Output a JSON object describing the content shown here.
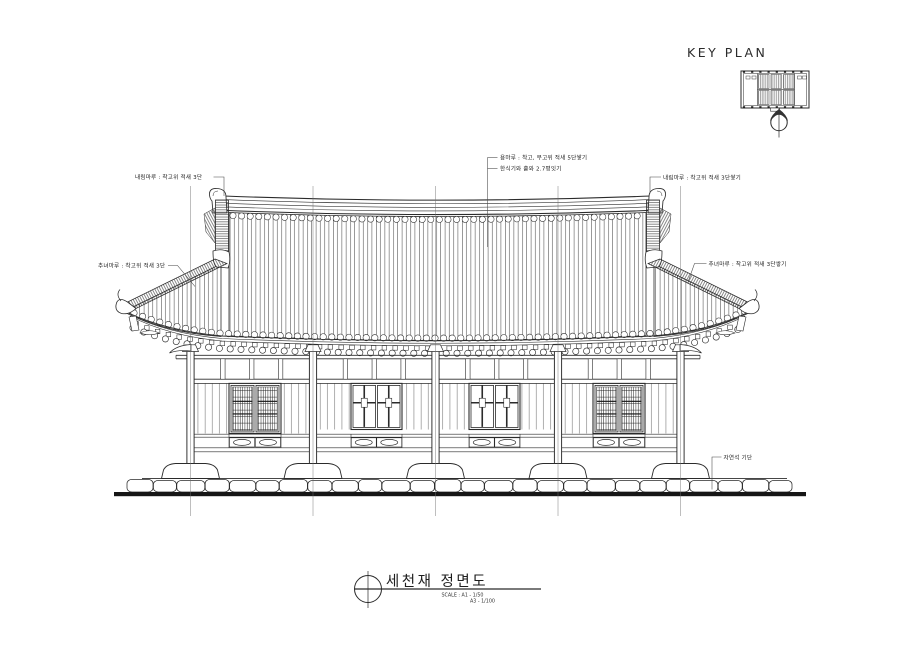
{
  "page": {
    "background": "#ffffff",
    "line_color": "#2b2b2b"
  },
  "key_plan": {
    "label": "KEY PLAN"
  },
  "annotations": {
    "ridge_line1": "용마루 : 착고, 부고위 적새 5단쌓기",
    "ridge_line2": "한식기와 홑와 2.7평잇기",
    "left_naerim": "내림마루 : 착고위 적새 3단",
    "left_chunyeo": "추녀마루 : 착고위 적새 3단",
    "right_naerim": "내림마루 : 착고위 적새 3단쌓기",
    "right_chunyeo": "추녀마루 : 착고위 적새 3단쌓기",
    "foundation": "자연석 기단"
  },
  "title_block": {
    "drawing_title": "세천재 정면도",
    "scale_line1": "SCALE : A1 - 1/50",
    "scale_line2": "A3 - 1/100"
  }
}
